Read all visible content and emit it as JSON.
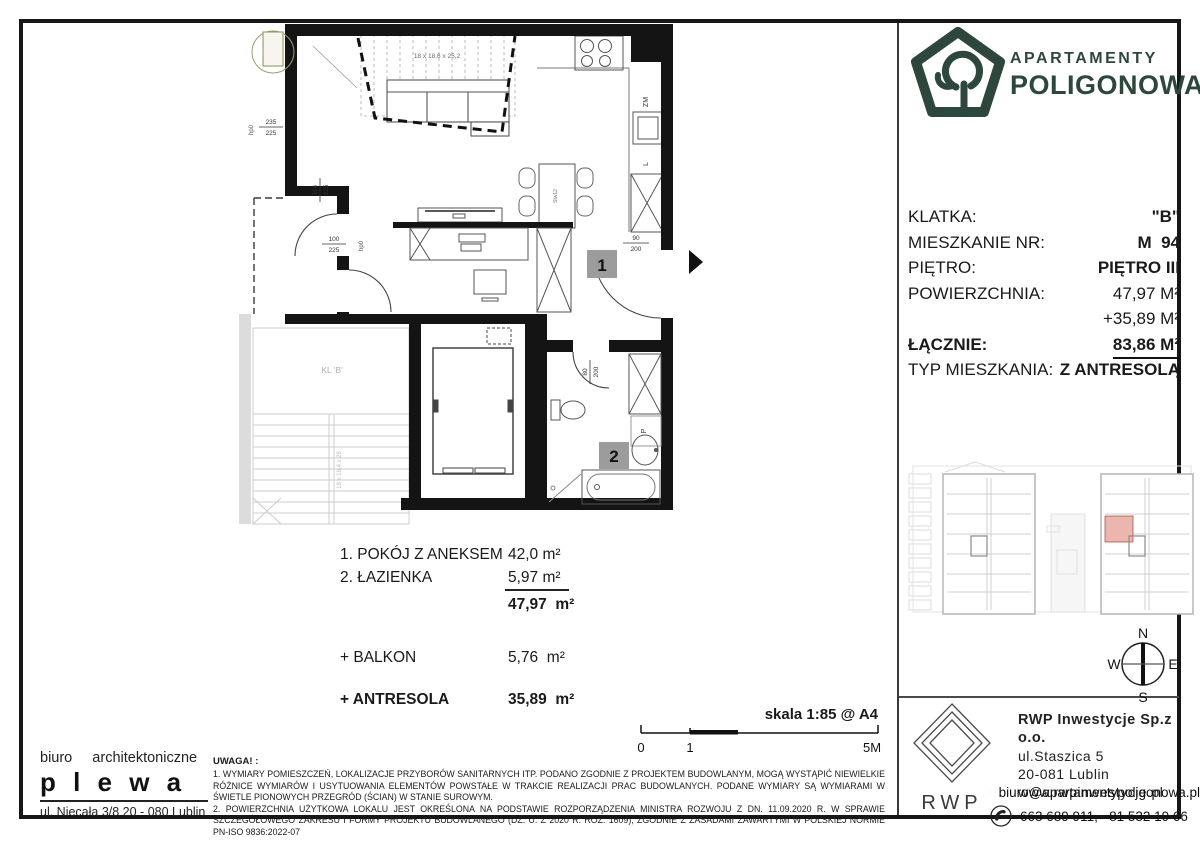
{
  "brand": {
    "line1": "APARTAMENTY",
    "line2": "POLIGONOWA",
    "color": "#2d473c"
  },
  "details": {
    "rows": [
      {
        "label": "KLATKA:",
        "value": "\"B\""
      },
      {
        "label": "MIESZKANIE NR:",
        "value": "M  94"
      },
      {
        "label": "PIĘTRO:",
        "value": "PIĘTRO III"
      },
      {
        "label": "POWIERZCHNIA:",
        "value": "47,97 M²"
      },
      {
        "label": "",
        "value": "+35,89 M²"
      },
      {
        "label": "ŁĄCZNIE:",
        "value": "83,86 M²"
      }
    ],
    "type_label": "TYP MIESZKANIA:",
    "type_value": "Z ANTRESOLĄ"
  },
  "legend": {
    "rooms": [
      {
        "name": "1. POKÓJ Z ANEKSEM",
        "area": "42,0 m²"
      },
      {
        "name": "2. ŁAZIENKA",
        "area": "5,97 m²"
      }
    ],
    "total": "47,97  m²",
    "extras": [
      {
        "name": "+ BALKON",
        "area": "5,76  m²"
      },
      {
        "name": "+ ANTRESOLA",
        "area": "35,89  m²"
      }
    ]
  },
  "scalebar": {
    "label": "skala 1:85 @ A4",
    "tick0": "0",
    "tick1": "1",
    "tick2": "5M"
  },
  "plan": {
    "marker1": "1",
    "marker2": "2",
    "zm": "ZM",
    "l": "L",
    "p": "P",
    "kl": "KL 'B'",
    "stair_mezz": "18 x 18,6 x 25,2",
    "stair_core": "18 x 16,4 x 28",
    "hp0": "hp0",
    "table_code": "Stw12",
    "dim_window": {
      "a": "235",
      "b": "225"
    },
    "dim_door_balc1": {
      "a": "114",
      "b": "225"
    },
    "dim_door_balc2": {
      "a": "100",
      "b": "225"
    },
    "dim_entry": {
      "a": "90",
      "b": "200"
    },
    "dim_bath": {
      "a": "80",
      "b": "200"
    }
  },
  "compass": {
    "n": "N",
    "e": "E",
    "s": "S",
    "w": "W"
  },
  "architect": {
    "line1": "biuro  architektoniczne",
    "name": "p l e w a",
    "address": "ul. Niecała 3/8  20 - 080 Lublin"
  },
  "disclaimer": {
    "title": "UWAGA! :",
    "line1": "1. WYMIARY POMIESZCZEŃ, LOKALIZACJE PRZYBORÓW SANITARNYCH ITP. PODANO ZGODNIE Z PROJEKTEM BUDOWLANYM, MOGĄ WYSTĄPIĆ NIEWIELKIE RÓŻNICE WYMIARÓW I USYTUOWANIA ELEMENTÓW POWSTAŁE W TRAKCIE REALIZACJI PRAC BUDOWLANYCH. PODANE WYMIARY SĄ WYMIARAMI W ŚWIETLE PIONOWYCH PRZEGRÓD (ŚCIAN) W STANIE SUROWYM.",
    "line2": "2. POWIERZCHNIA UŻYTKOWA LOKALU JEST OKREŚLONA NA PODSTAWIE ROZPORZĄDZENIA MINISTRA ROZWOJU Z DN. 11.09.2020 R. W SPRAWIE SZCZEGÓŁOWEGO ZAKRESU I FORMY PROJEKTU BUDOWLANEGO (DZ. U. Z 2020 R. ROZ. 1609), ZGODNIE Z ZASADAMI ZAWARTYMI W POLSKIEJ NORMIE PN-ISO 9836:2022-07"
  },
  "developer": {
    "logo_text": "RWP",
    "company": "RWP Inwestycje Sp.z o.o.",
    "street": "ul.Staszica 5",
    "city": "20-081 Lublin",
    "website": "www.rwpinwestycje.pl",
    "email": "biuro@apartamentypoligonowa.pl",
    "phones": "663 689 911,   81 532 19 66"
  }
}
